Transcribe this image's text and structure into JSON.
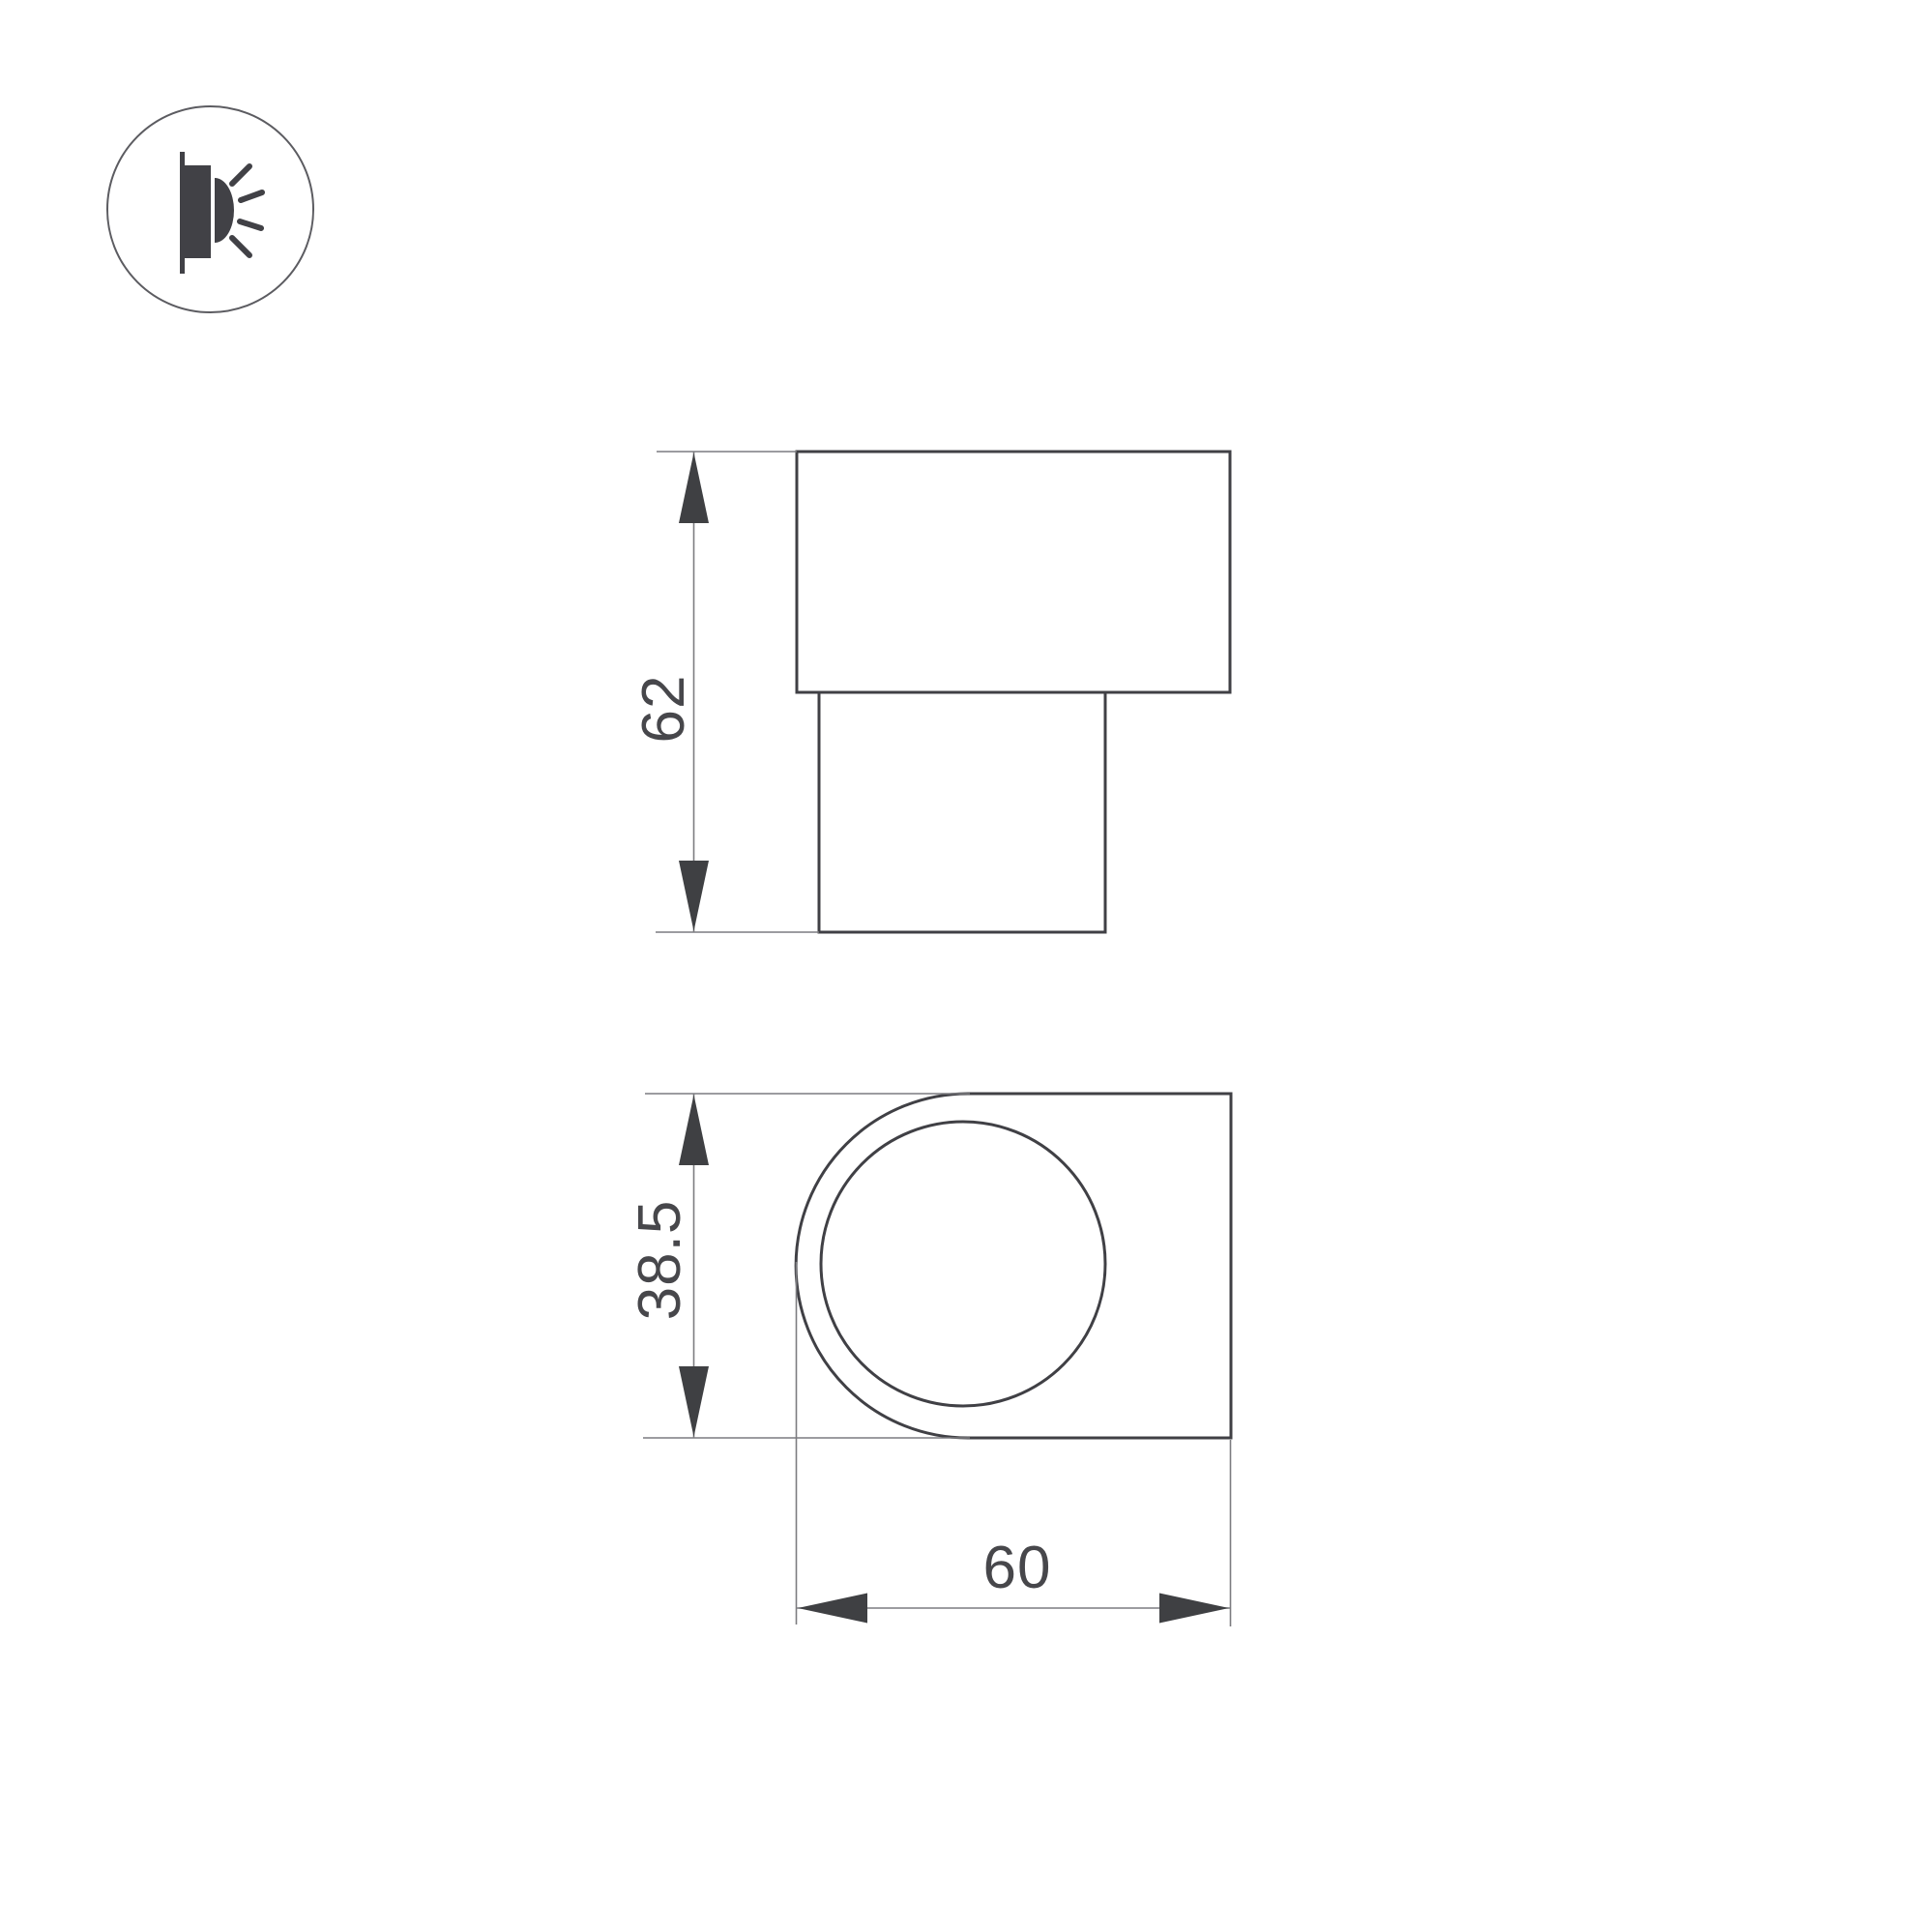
{
  "drawing": {
    "type": "technical-dimension-drawing",
    "icon": "wall-mounted-light-emitting-icon",
    "views": {
      "side_view": {
        "name": "side-view"
      },
      "front_view": {
        "name": "front-view"
      }
    }
  },
  "dimensions": {
    "side_view_height": "62",
    "front_view_height": "38.5",
    "front_view_width": "60"
  },
  "colors": {
    "background": "#ffffff",
    "outline": "#404045",
    "dim_line": "#7c7c80",
    "dim_fill": "#3f4043",
    "dim_text": "#47474b",
    "icon_fill": "#414146",
    "icon_circle": "#5c5c61"
  }
}
